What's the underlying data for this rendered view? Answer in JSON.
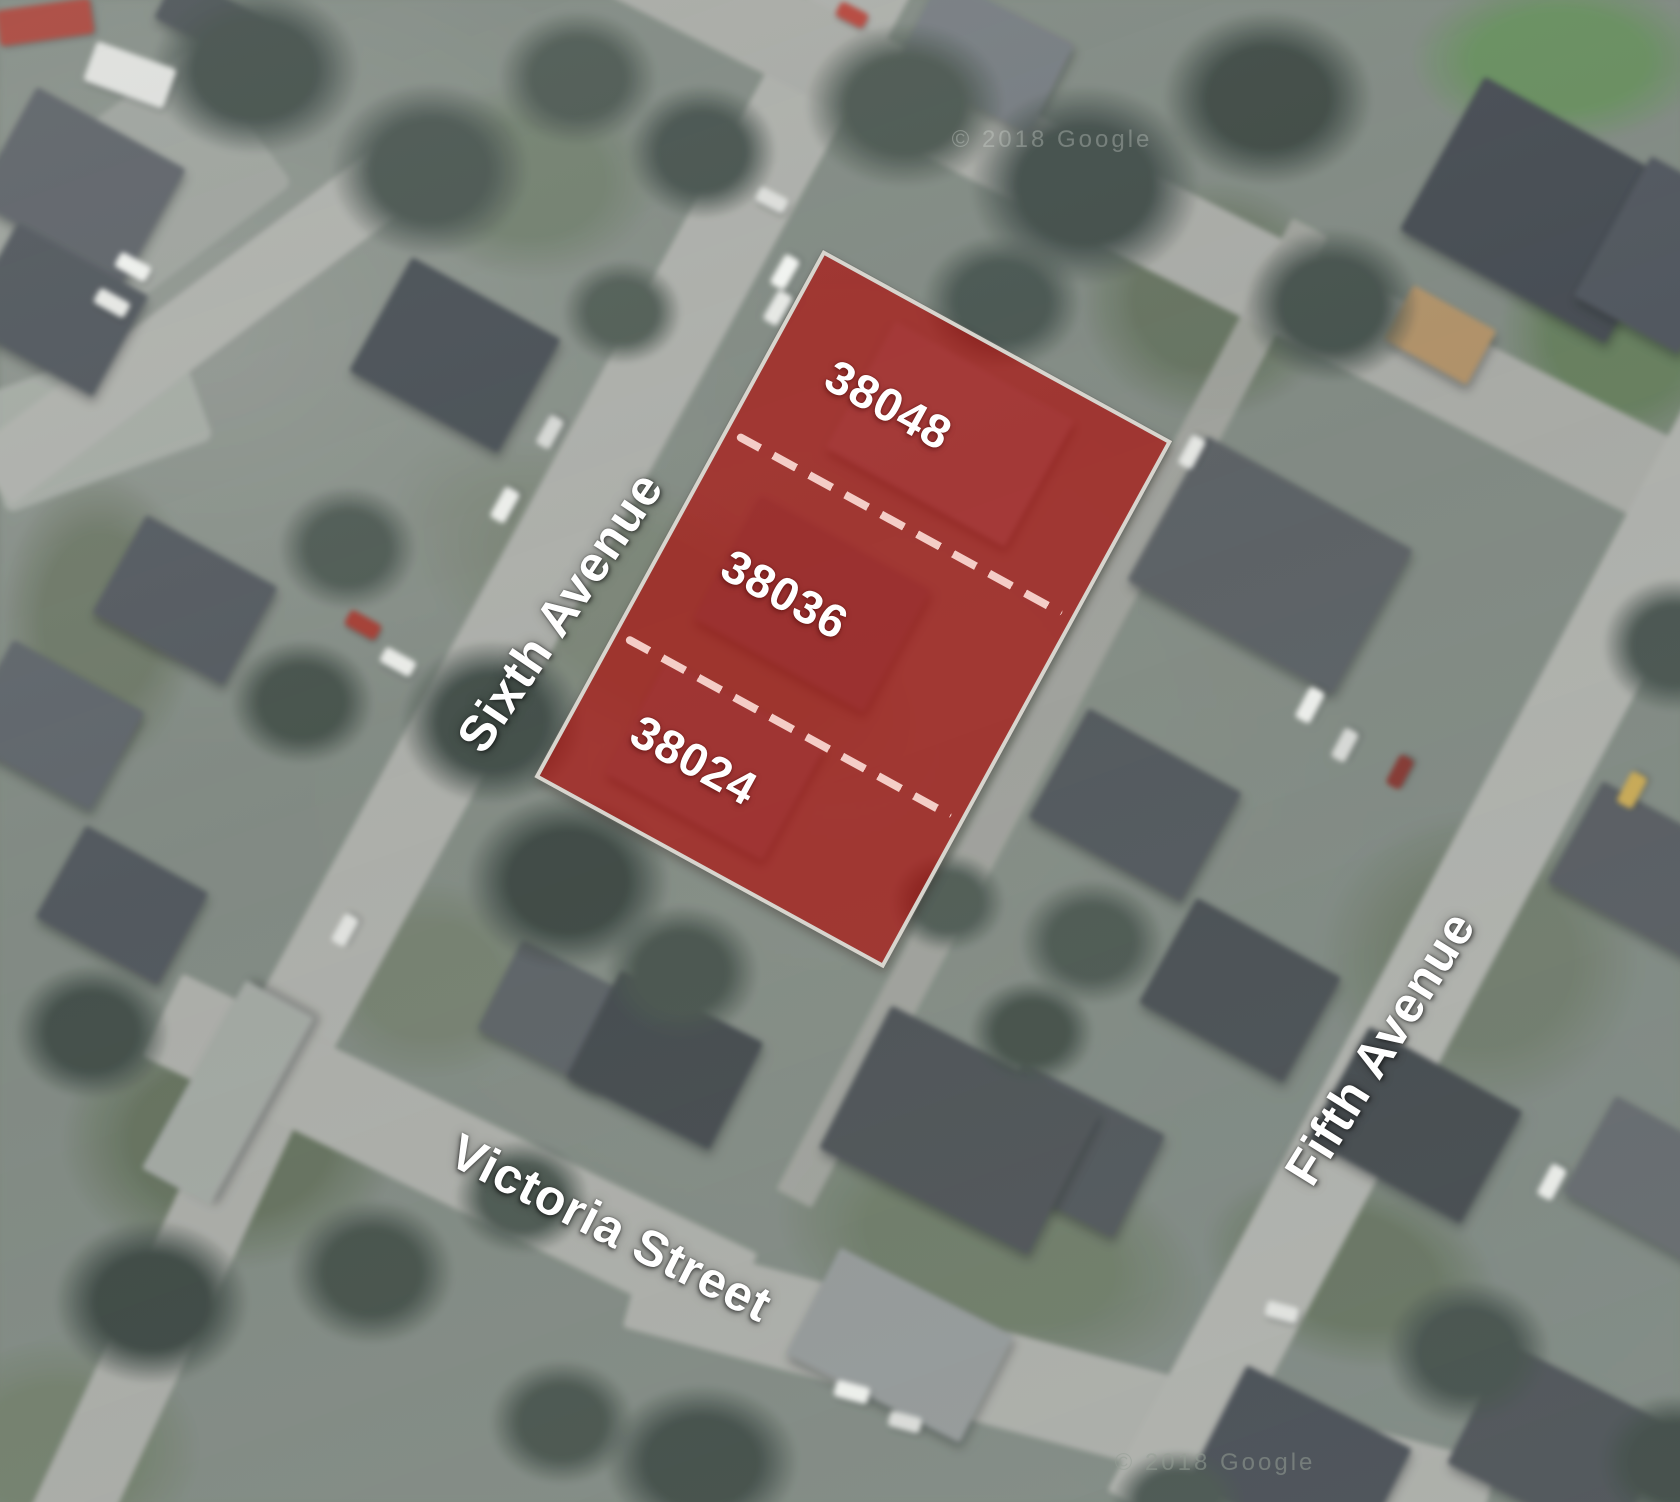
{
  "map_annotations": {
    "lots": [
      {
        "number": "38048"
      },
      {
        "number": "38036"
      },
      {
        "number": "38024"
      }
    ],
    "streets": [
      {
        "name": "Sixth Avenue"
      },
      {
        "name": "Fifth Avenue"
      },
      {
        "name": "Victoria Street"
      }
    ],
    "watermark": "© 2018 Google",
    "colors": {
      "parcel_fill": "#af0a08",
      "parcel_fill_opacity": "0.66",
      "parcel_border": "#d8d5ce",
      "lot_divider_dash": "#ffe2db",
      "label_text": "#ffffff"
    }
  }
}
